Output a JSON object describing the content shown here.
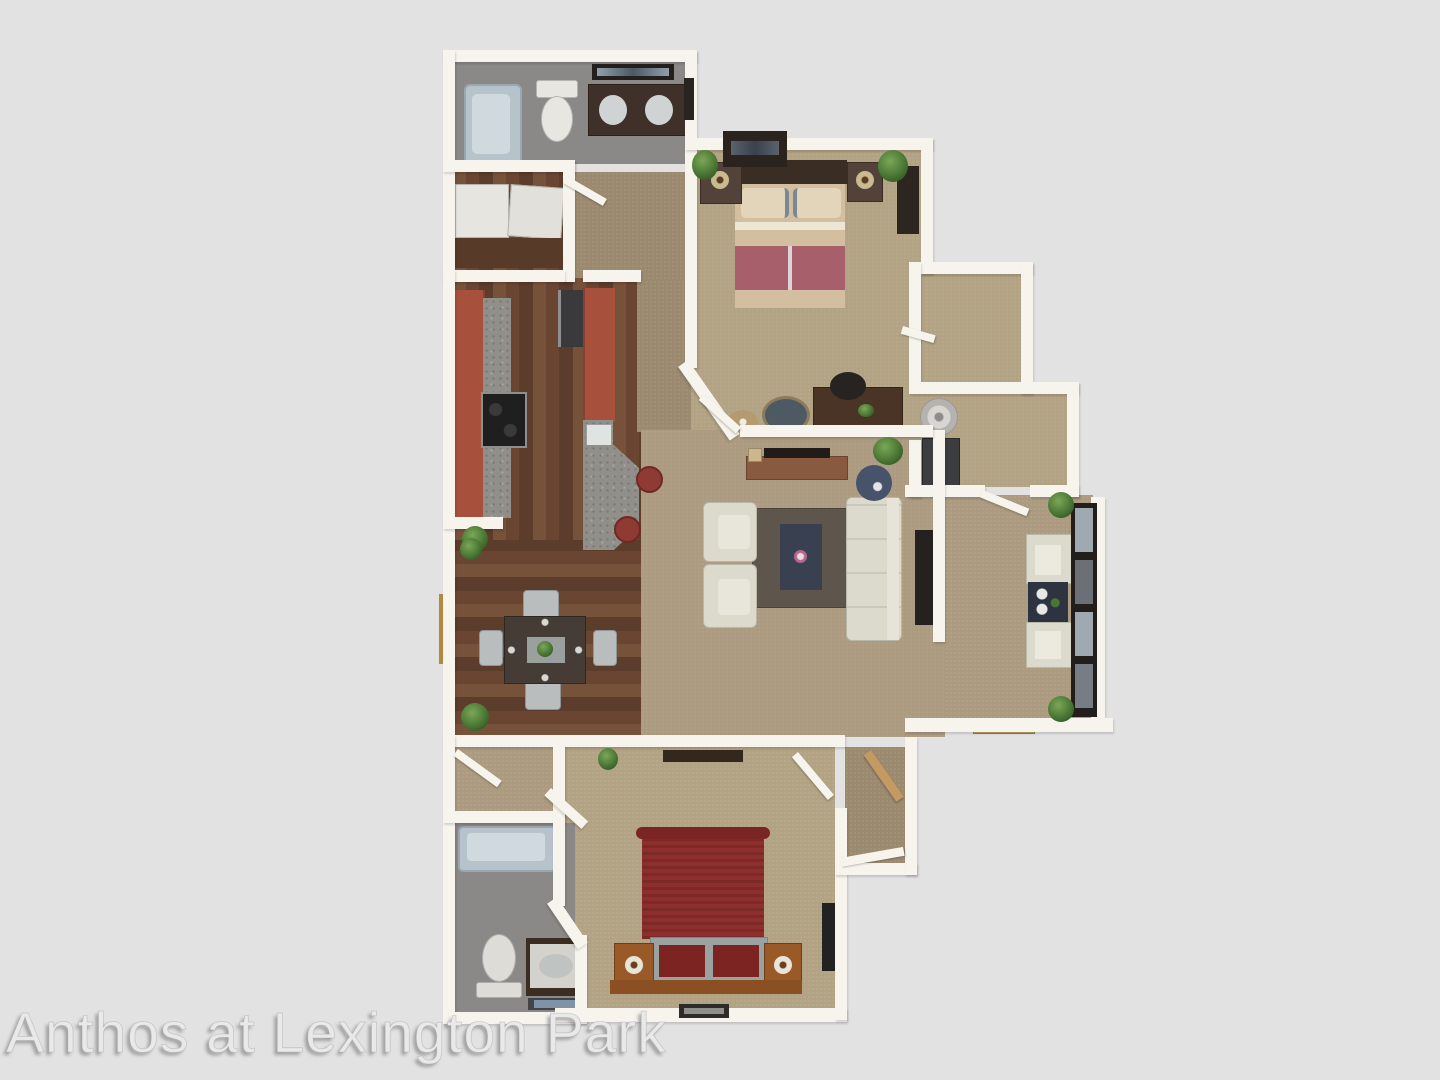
{
  "scene": {
    "kind": "3D apartment floor plan rendering, top-down view",
    "background_color": "#e2e2e3"
  },
  "watermark": {
    "text": "Anthos at Lexington Park"
  },
  "palette": {
    "wall": "#f7f4ee",
    "carpet": "#ac9b80",
    "wood_floor": "#6a4632",
    "bath_floor": "#8b8987",
    "kitchen_cabinet_brick": "#a7503c",
    "granite_counter": "#908f8a",
    "bathtub": "#b7c3cb",
    "sofa_cream": "#dcdacc",
    "area_rug": "#5e554c",
    "coffee_table_navy": "#39404f",
    "bed_upper_blanket": "#a65f6b",
    "bed_upper_linen": "#d3bfa0",
    "bed_lower_red": "#8e2f2e",
    "bar_stool_red": "#8f3a33",
    "dark_wood_furniture": "#3b2d22",
    "plant_green": "#4a7634"
  },
  "rooms": [
    {
      "name": "bathroom-upper",
      "floor": "gray tile",
      "furniture": [
        "bathtub",
        "toilet",
        "double-sink vanity",
        "mirror"
      ]
    },
    {
      "name": "laundry-closet",
      "floor": "wood",
      "furniture": [
        "washer",
        "dryer",
        "cabinet"
      ]
    },
    {
      "name": "kitchen",
      "floor": "wood",
      "furniture": [
        "range",
        "refrigerator",
        "sink",
        "breakfast bar",
        "2 bar stools"
      ]
    },
    {
      "name": "dining-room",
      "floor": "wood",
      "furniture": [
        "dining table",
        "4 chairs",
        "side window"
      ]
    },
    {
      "name": "living-room",
      "floor": "carpet",
      "furniture": [
        "sofa",
        "2 armchairs",
        "area rug",
        "coffee table",
        "media console",
        "side table",
        "wall tv"
      ]
    },
    {
      "name": "bedroom-upper",
      "floor": "carpet",
      "furniture": [
        "bed",
        "2 nightstands",
        "tv stand",
        "dresser",
        "desk",
        "desk chair",
        "2 ottomans"
      ]
    },
    {
      "name": "walk-in-closet",
      "floor": "carpet",
      "furniture": []
    },
    {
      "name": "utility-room",
      "floor": "carpet",
      "furniture": [
        "water heater",
        "hvac unit"
      ]
    },
    {
      "name": "sunroom-patio",
      "floor": "carpet",
      "furniture": [
        "2 chairs",
        "side table",
        "window wall",
        "doormat",
        "plants"
      ]
    },
    {
      "name": "bedroom-lower",
      "floor": "carpet",
      "furniture": [
        "red bed",
        "bench with cushions",
        "2 nightstands with lamps",
        "platform",
        "window",
        "wall shelf"
      ]
    },
    {
      "name": "bathroom-lower",
      "floor": "gray tile",
      "furniture": [
        "bathtub",
        "toilet",
        "vanity",
        "bath mat"
      ]
    },
    {
      "name": "entry-hall",
      "floor": "carpet",
      "furniture": [
        "front door",
        "interior door",
        "closet"
      ]
    }
  ]
}
